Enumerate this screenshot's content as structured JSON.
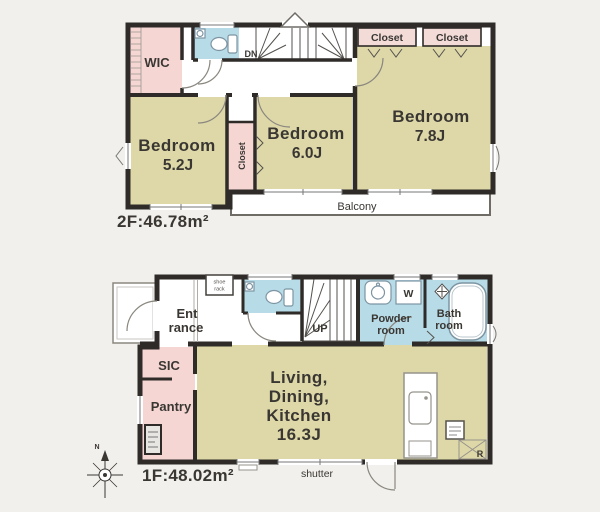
{
  "colors": {
    "background": "#f2f0ec",
    "room_beige": "#ded8a9",
    "room_pink": "#f5d6d3",
    "room_blue": "#b7dbe7",
    "wall": "#2e2b28",
    "text": "#3a3733"
  },
  "floor2": {
    "area_label": "2F:46.78m²",
    "wic_label": "WIC",
    "stairs_down_label": "DN",
    "closet_top_left": "Closet",
    "closet_top_right": "Closet",
    "closet_side_vertical": "Closet",
    "bedroom_52": {
      "name": "Bedroom",
      "size": "5.2J"
    },
    "bedroom_60": {
      "name": "Bedroom",
      "size": "6.0J"
    },
    "bedroom_78": {
      "name": "Bedroom",
      "size": "7.8J"
    },
    "balcony_label": "Balcony"
  },
  "floor1": {
    "area_label": "1F:48.02m²",
    "entrance": {
      "lines": [
        "Ent",
        "rance"
      ]
    },
    "shoe_rack": {
      "lines": [
        "shoe",
        "rack"
      ]
    },
    "sic_label": "SIC",
    "pantry_label": "Pantry",
    "stairs_up_label": "UP",
    "powder_room": {
      "lines": [
        "Powder",
        "room"
      ]
    },
    "washer_label": "W",
    "bath_room": {
      "lines": [
        "Bath",
        "room"
      ]
    },
    "ldk": {
      "lines": [
        "Living,",
        "Dining,",
        "Kitchen",
        "16.3J"
      ]
    },
    "shutter_label": "shutter",
    "refrigerator_label": "R",
    "compass_north": "N"
  }
}
